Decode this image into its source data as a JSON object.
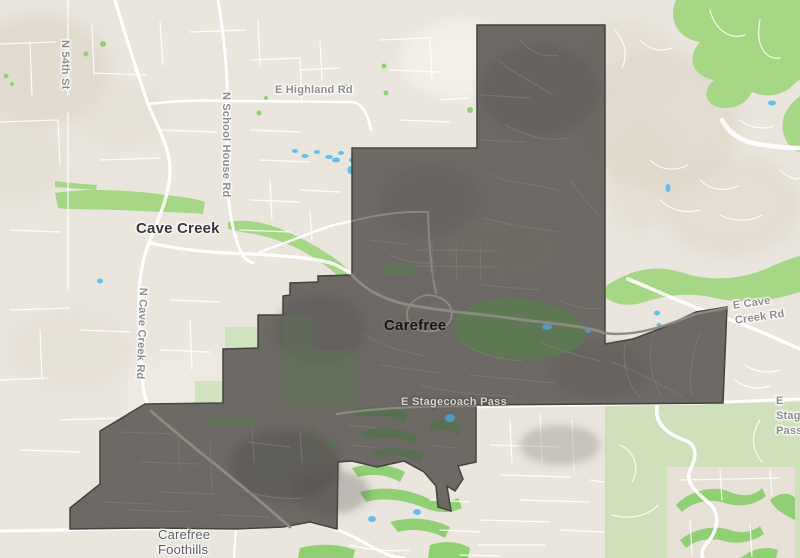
{
  "map_title": "Carefree boundary map",
  "labels": [
    {
      "id": "n-54th-st",
      "text": "N 54th St",
      "kind": "road"
    },
    {
      "id": "e-highland-rd",
      "text": "E Highland Rd",
      "kind": "road"
    },
    {
      "id": "n-school-house-rd",
      "text": "N School House Rd",
      "kind": "road"
    },
    {
      "id": "cave-creek",
      "text": "Cave Creek",
      "kind": "town"
    },
    {
      "id": "n-cave-creek-rd",
      "text": "N Cave Creek Rd",
      "kind": "road"
    },
    {
      "id": "carefree",
      "text": "Carefree",
      "kind": "town"
    },
    {
      "id": "e-cave-creek-rd",
      "text": "E Cave Creek Rd",
      "kind": "road"
    },
    {
      "id": "e-stagecoach-pass",
      "text": "E Stagecoach Pass",
      "kind": "road-on-overlay"
    },
    {
      "id": "e-stagecoach-pass-e",
      "text": "E Stagecoach Pass",
      "kind": "road"
    },
    {
      "id": "carefree-foothills",
      "text": "Carefree\nFoothills",
      "kind": "neighborhood"
    }
  ],
  "overlay": {
    "name": "Carefree town boundary highlight",
    "fill": "#676460",
    "border": "#45433f"
  },
  "colors": {
    "land": "#eae6de",
    "terrain_shade": "#dcd4c5",
    "park_green": "#a5d784",
    "pale_green": "#cfe0ba",
    "golf_green": "#8fd172",
    "overlay_park": "#5c7a52",
    "water": "#5fc2ee",
    "water_under_overlay": "#4c9dc0",
    "road": "#ffffff",
    "overlay_road": "#8d8a84",
    "town_label": "#36373b",
    "road_label": "#8d8d8d",
    "neighborhood_label": "#5d6066"
  }
}
